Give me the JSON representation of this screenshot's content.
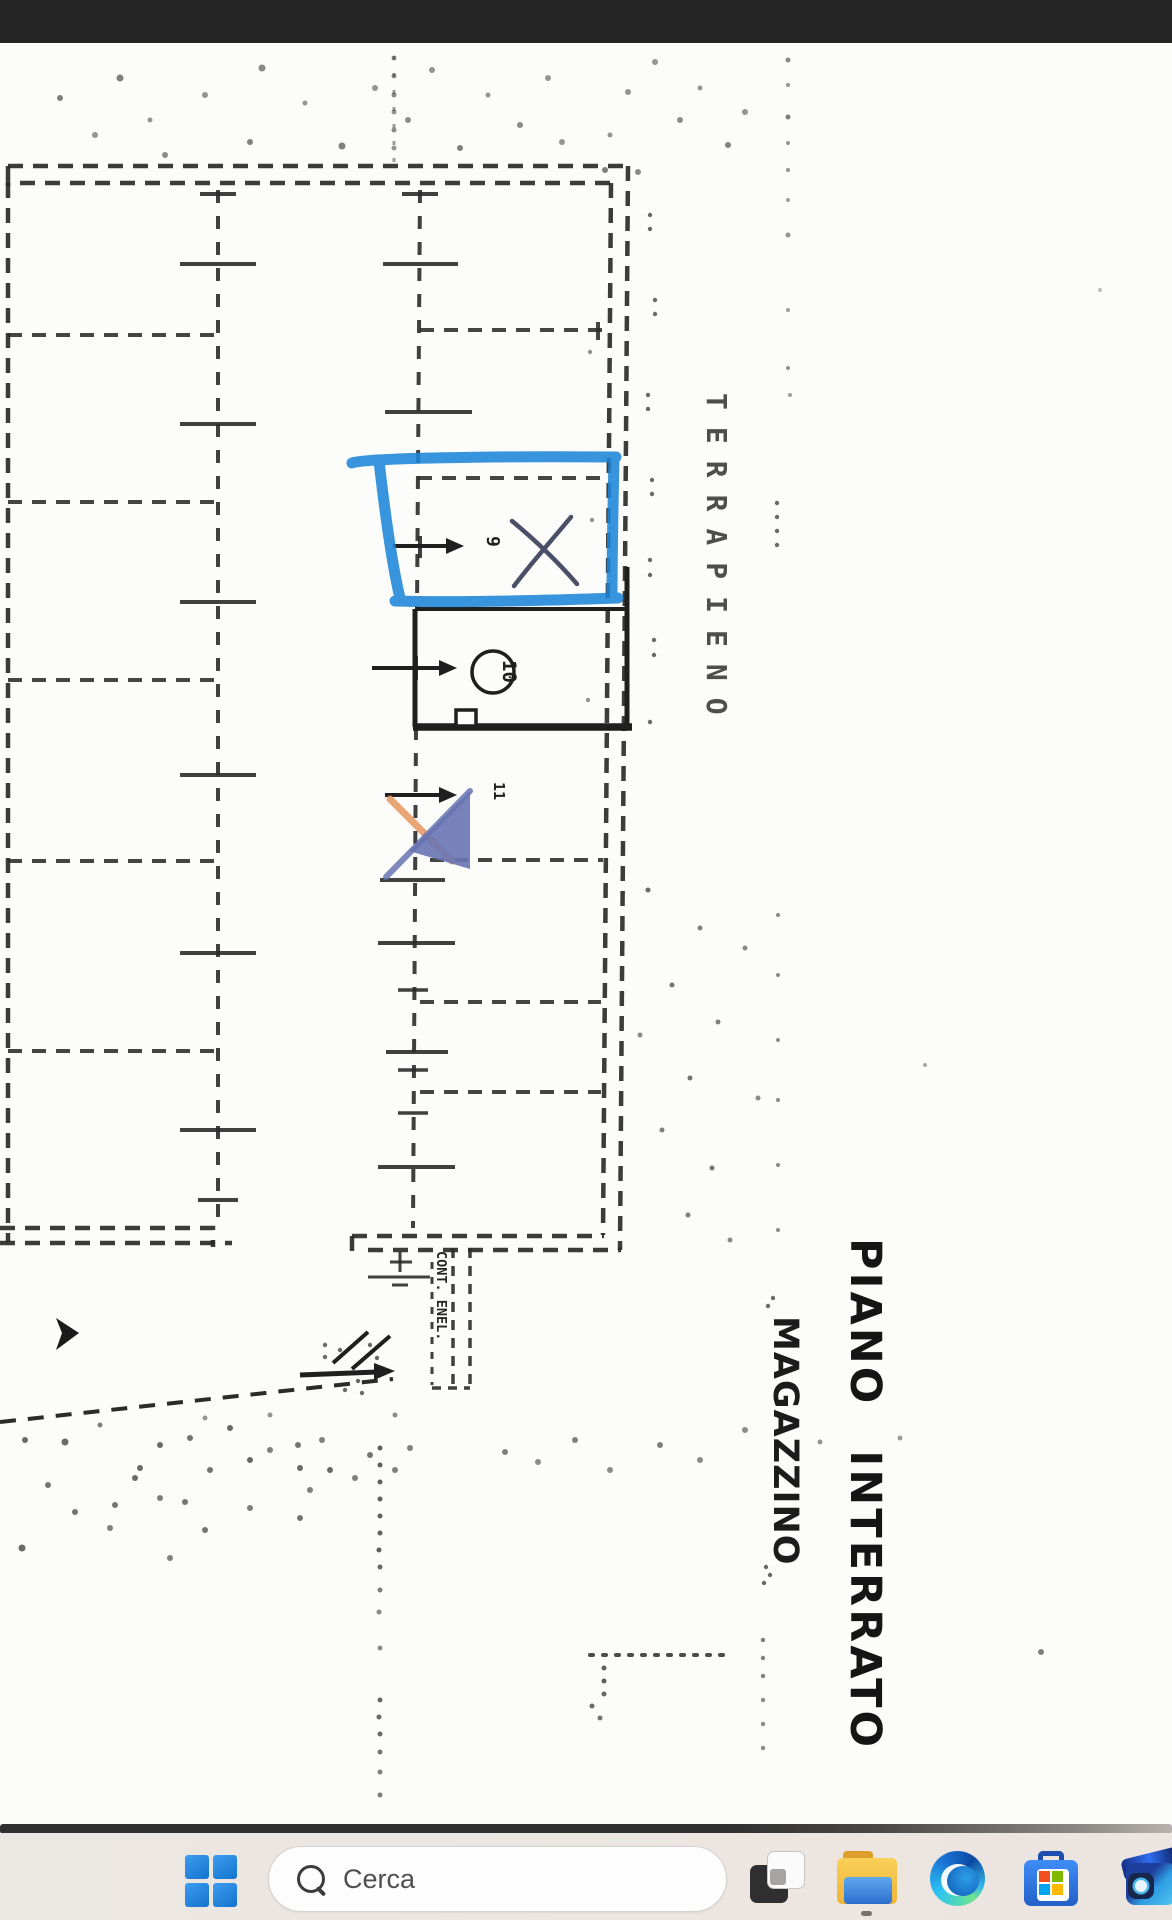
{
  "plan": {
    "labels": {
      "terrapieno": "TERRAPIENO",
      "piano_interrato": "PIANO INTERRATO",
      "magazzino": "MAGAZZINO",
      "cont_enel": "CONT. ENEL."
    },
    "units": {
      "u9": "9",
      "u10": "10",
      "u11": "11"
    },
    "annotation_colors": {
      "highlighter_blue": "#1d86d8",
      "pen_blue": "#4b5068",
      "watermark_blue": "#6874b2",
      "watermark_orange": "#e8965f"
    },
    "noise_dots": [
      [
        60,
        98,
        3,
        0.6
      ],
      [
        95,
        135,
        3,
        0.5
      ],
      [
        120,
        78,
        3.5,
        0.6
      ],
      [
        150,
        120,
        2.5,
        0.5
      ],
      [
        165,
        155,
        3,
        0.55
      ],
      [
        205,
        95,
        3,
        0.5
      ],
      [
        250,
        142,
        3,
        0.6
      ],
      [
        262,
        68,
        3.5,
        0.55
      ],
      [
        305,
        103,
        2.5,
        0.5
      ],
      [
        342,
        146,
        3.5,
        0.6
      ],
      [
        375,
        88,
        3,
        0.5
      ],
      [
        408,
        120,
        3,
        0.55
      ],
      [
        432,
        70,
        3,
        0.5
      ],
      [
        460,
        148,
        3,
        0.6
      ],
      [
        488,
        95,
        2.5,
        0.5
      ],
      [
        520,
        125,
        3,
        0.55
      ],
      [
        548,
        78,
        3,
        0.5
      ],
      [
        562,
        142,
        3,
        0.5
      ],
      [
        605,
        170,
        3,
        0.6
      ],
      [
        628,
        92,
        3,
        0.5
      ],
      [
        655,
        62,
        3,
        0.5
      ],
      [
        680,
        120,
        3,
        0.55
      ],
      [
        700,
        88,
        2.5,
        0.5
      ],
      [
        728,
        145,
        3,
        0.6
      ],
      [
        745,
        112,
        3,
        0.5
      ],
      [
        610,
        135,
        2.5,
        0.5
      ],
      [
        638,
        172,
        3,
        0.55
      ],
      [
        394,
        58,
        2.5,
        0.5
      ],
      [
        394,
        76,
        2.5,
        0.5
      ],
      [
        394,
        95,
        2.5,
        0.55
      ],
      [
        394,
        112,
        2.5,
        0.5
      ],
      [
        394,
        130,
        2.5,
        0.55
      ],
      [
        394,
        148,
        2.5,
        0.5
      ],
      [
        788,
        60,
        2.5,
        0.55
      ],
      [
        788,
        85,
        2,
        0.5
      ],
      [
        788,
        117,
        2.5,
        0.6
      ],
      [
        788,
        143,
        2,
        0.5
      ],
      [
        788,
        170,
        2,
        0.5
      ],
      [
        788,
        200,
        2,
        0.45
      ],
      [
        788,
        235,
        2.5,
        0.5
      ],
      [
        788,
        310,
        2,
        0.45
      ],
      [
        788,
        368,
        2,
        0.5
      ],
      [
        790,
        395,
        2,
        0.45
      ],
      [
        650,
        215,
        2.2,
        0.7
      ],
      [
        650,
        229,
        2.2,
        0.7
      ],
      [
        655,
        300,
        2.2,
        0.7
      ],
      [
        655,
        314,
        2.2,
        0.7
      ],
      [
        648,
        395,
        2.2,
        0.7
      ],
      [
        648,
        409,
        2.2,
        0.7
      ],
      [
        652,
        480,
        2.2,
        0.7
      ],
      [
        652,
        494,
        2.2,
        0.7
      ],
      [
        650,
        560,
        2.2,
        0.7
      ],
      [
        650,
        575,
        2.2,
        0.7
      ],
      [
        654,
        640,
        2.2,
        0.7
      ],
      [
        654,
        655,
        2.2,
        0.7
      ],
      [
        650,
        722,
        2.2,
        0.7
      ],
      [
        777,
        503,
        2.2,
        0.7
      ],
      [
        777,
        517,
        2.2,
        0.7
      ],
      [
        777,
        531,
        2.2,
        0.7
      ],
      [
        777,
        545,
        2.2,
        0.7
      ],
      [
        590,
        352,
        2.2,
        0.5
      ],
      [
        592,
        520,
        2.2,
        0.5
      ],
      [
        588,
        700,
        2.2,
        0.5
      ],
      [
        648,
        890,
        2.5,
        0.7
      ],
      [
        700,
        928,
        2.5,
        0.6
      ],
      [
        672,
        985,
        2.5,
        0.65
      ],
      [
        718,
        1022,
        2.5,
        0.6
      ],
      [
        690,
        1078,
        2.5,
        0.65
      ],
      [
        662,
        1130,
        2.5,
        0.6
      ],
      [
        712,
        1168,
        2.5,
        0.65
      ],
      [
        745,
        948,
        2.5,
        0.55
      ],
      [
        758,
        1098,
        2.5,
        0.55
      ],
      [
        688,
        1215,
        2.5,
        0.6
      ],
      [
        640,
        1035,
        2.5,
        0.55
      ],
      [
        730,
        1240,
        2.5,
        0.55
      ],
      [
        778,
        915,
        2,
        0.55
      ],
      [
        778,
        975,
        2,
        0.55
      ],
      [
        778,
        1040,
        2,
        0.55
      ],
      [
        778,
        1100,
        2,
        0.55
      ],
      [
        778,
        1165,
        2,
        0.55
      ],
      [
        778,
        1230,
        2,
        0.55
      ],
      [
        773,
        1298,
        2.2,
        0.7
      ],
      [
        768,
        1306,
        2.2,
        0.7
      ],
      [
        766,
        1567,
        2.2,
        0.7
      ],
      [
        770,
        1575,
        2.2,
        0.7
      ],
      [
        764,
        1583,
        2.2,
        0.7
      ],
      [
        25,
        1440,
        3,
        0.7
      ],
      [
        65,
        1442,
        3.5,
        0.7
      ],
      [
        48,
        1485,
        3,
        0.65
      ],
      [
        140,
        1468,
        3,
        0.7
      ],
      [
        100,
        1425,
        2.5,
        0.6
      ],
      [
        160,
        1445,
        3,
        0.7
      ],
      [
        190,
        1438,
        3,
        0.65
      ],
      [
        230,
        1428,
        3,
        0.7
      ],
      [
        115,
        1505,
        3,
        0.65
      ],
      [
        135,
        1478,
        3,
        0.7
      ],
      [
        185,
        1502,
        3,
        0.65
      ],
      [
        110,
        1528,
        3,
        0.6
      ],
      [
        75,
        1512,
        3,
        0.65
      ],
      [
        22,
        1548,
        3.5,
        0.7
      ],
      [
        210,
        1470,
        3,
        0.65
      ],
      [
        250,
        1460,
        3,
        0.7
      ],
      [
        270,
        1450,
        3,
        0.6
      ],
      [
        300,
        1468,
        3,
        0.7
      ],
      [
        160,
        1498,
        3,
        0.6
      ],
      [
        205,
        1530,
        3,
        0.65
      ],
      [
        310,
        1490,
        3,
        0.6
      ],
      [
        330,
        1470,
        3,
        0.7
      ],
      [
        355,
        1478,
        3,
        0.6
      ],
      [
        300,
        1518,
        3,
        0.65
      ],
      [
        250,
        1508,
        3,
        0.6
      ],
      [
        370,
        1455,
        3,
        0.65
      ],
      [
        395,
        1470,
        3,
        0.6
      ],
      [
        170,
        1558,
        3,
        0.6
      ],
      [
        298,
        1445,
        3,
        0.65
      ],
      [
        322,
        1440,
        3,
        0.6
      ],
      [
        410,
        1448,
        3,
        0.6
      ],
      [
        395,
        1415,
        2.5,
        0.55
      ],
      [
        205,
        1418,
        2.5,
        0.5
      ],
      [
        270,
        1415,
        2.5,
        0.5
      ],
      [
        505,
        1452,
        3,
        0.6
      ],
      [
        538,
        1462,
        3,
        0.55
      ],
      [
        575,
        1440,
        3,
        0.6
      ],
      [
        610,
        1470,
        3,
        0.55
      ],
      [
        660,
        1445,
        3,
        0.6
      ],
      [
        700,
        1460,
        3,
        0.55
      ],
      [
        745,
        1430,
        3,
        0.55
      ],
      [
        820,
        1442,
        2.5,
        0.5
      ],
      [
        900,
        1438,
        2.5,
        0.45
      ],
      [
        325,
        1345,
        2.2,
        0.7
      ],
      [
        325,
        1357,
        2.2,
        0.7
      ],
      [
        340,
        1350,
        2.2,
        0.7
      ],
      [
        358,
        1381,
        2.2,
        0.7
      ],
      [
        362,
        1393,
        2.2,
        0.7
      ],
      [
        370,
        1345,
        2.2,
        0.7
      ],
      [
        377,
        1358,
        2.2,
        0.7
      ],
      [
        345,
        1390,
        2.2,
        0.7
      ],
      [
        380,
        1448,
        2.5,
        0.75
      ],
      [
        380,
        1465,
        2.5,
        0.75
      ],
      [
        380,
        1482,
        2.5,
        0.75
      ],
      [
        380,
        1499,
        2.5,
        0.75
      ],
      [
        380,
        1516,
        2.5,
        0.75
      ],
      [
        380,
        1533,
        2.5,
        0.75
      ],
      [
        379,
        1550,
        2.5,
        0.75
      ],
      [
        380,
        1567,
        2.5,
        0.7
      ],
      [
        380,
        1590,
        2.5,
        0.6
      ],
      [
        379,
        1612,
        2.5,
        0.55
      ],
      [
        380,
        1648,
        2.5,
        0.55
      ],
      [
        380,
        1700,
        2.5,
        0.7
      ],
      [
        379,
        1717,
        2.5,
        0.7
      ],
      [
        380,
        1734,
        2.5,
        0.7
      ],
      [
        380,
        1752,
        2.5,
        0.65
      ],
      [
        380,
        1772,
        2.5,
        0.6
      ],
      [
        380,
        1795,
        2.5,
        0.6
      ],
      [
        604,
        1668,
        2.5,
        0.75
      ],
      [
        604,
        1681,
        2.5,
        0.75
      ],
      [
        604,
        1694,
        2.5,
        0.7
      ],
      [
        592,
        1706,
        2.5,
        0.7
      ],
      [
        600,
        1718,
        2.5,
        0.65
      ],
      [
        763,
        1640,
        2.2,
        0.6
      ],
      [
        763,
        1658,
        2.2,
        0.6
      ],
      [
        763,
        1676,
        2.2,
        0.6
      ],
      [
        763,
        1700,
        2.2,
        0.55
      ],
      [
        763,
        1724,
        2.2,
        0.55
      ],
      [
        763,
        1748,
        2.2,
        0.55
      ],
      [
        1041,
        1652,
        3,
        0.6
      ],
      [
        925,
        1065,
        2,
        0.4
      ],
      [
        1100,
        290,
        2,
        0.3
      ]
    ]
  },
  "taskbar": {
    "search": {
      "placeholder": "Cerca",
      "icon": "search-icon"
    },
    "buttons": [
      {
        "name": "start-button",
        "icon": "windows-logo-icon"
      },
      {
        "name": "task-view-button",
        "icon": "overlapping-panes-icon"
      },
      {
        "name": "file-explorer-button",
        "icon": "folder-icon",
        "running": true
      },
      {
        "name": "edge-button",
        "icon": "edge-swirl-icon"
      },
      {
        "name": "store-button",
        "icon": "shopping-bag-icon"
      },
      {
        "name": "photos-button",
        "icon": "blue-camera-app-icon"
      }
    ]
  }
}
